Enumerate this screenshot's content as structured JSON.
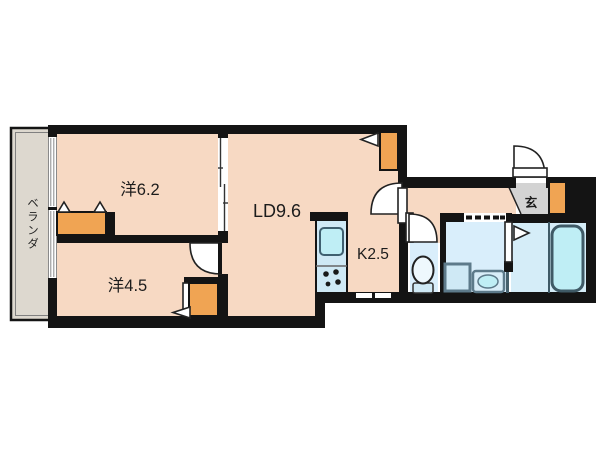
{
  "plan": {
    "type": "apartment-floorplan",
    "veranda_label": "ベランダ",
    "rooms": [
      {
        "id": "bedroom-6-2",
        "label": "洋6.2"
      },
      {
        "id": "living-dining",
        "label": "LD9.6"
      },
      {
        "id": "bedroom-4-5",
        "label": "洋4.5"
      },
      {
        "id": "kitchen",
        "label": "K2.5"
      },
      {
        "id": "entrance",
        "label": "玄"
      }
    ]
  },
  "colors": {
    "wall": "#141414",
    "room": "#f7d9c3",
    "closet": "#f0a453",
    "veranda": "#ddd8cf",
    "genkan": "#d3d3d3",
    "wet": "#d9eefb",
    "bath_floor": "#d5edf8",
    "fixture": "#cfe9f5",
    "fixture_deep": "#bfeef5",
    "fixture_stroke": "#3f5d6b",
    "appliance_stroke": "#5d7a8a"
  }
}
